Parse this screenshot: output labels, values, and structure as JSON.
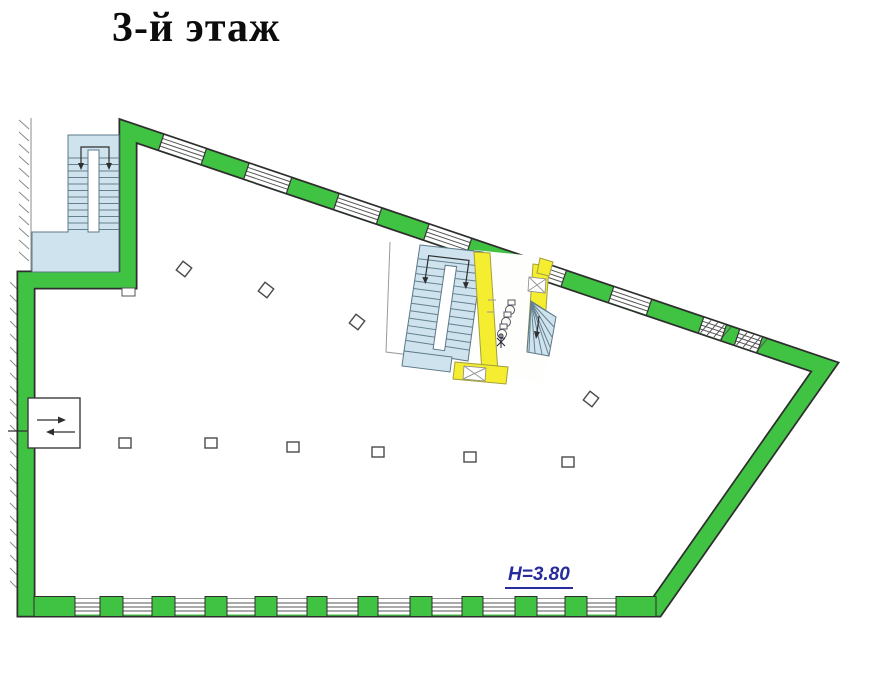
{
  "title": {
    "text": "3-й этаж"
  },
  "plan": {
    "height_label": "H=3.80",
    "colors": {
      "wall_green": "#40c342",
      "stair_blue": "#cfe3ee",
      "core_yellow": "#f5ed30",
      "label_blue": "#272c9c",
      "outline_dark": "#2e2e2e",
      "window_line": "#555555"
    },
    "top_wall_segments": [
      [
        "g",
        35
      ],
      [
        "w",
        45
      ],
      [
        "g",
        45
      ],
      [
        "w",
        45
      ],
      [
        "g",
        50
      ],
      [
        "w",
        45
      ],
      [
        "g",
        50
      ],
      [
        "w",
        45
      ],
      [
        "g",
        55
      ],
      [
        "w",
        45
      ],
      [
        "g",
        50
      ],
      [
        "w",
        40
      ],
      [
        "g",
        55
      ],
      [
        "h",
        24
      ],
      [
        "g",
        14
      ],
      [
        "h",
        24
      ],
      [
        "g",
        69
      ]
    ],
    "bottom_wall_piers": [
      [
        34,
        41
      ],
      [
        100,
        23
      ],
      [
        152,
        23
      ],
      [
        205,
        22
      ],
      [
        255,
        22
      ],
      [
        307,
        20
      ],
      [
        358,
        20
      ],
      [
        410,
        22
      ],
      [
        462,
        21
      ],
      [
        515,
        22
      ],
      [
        565,
        22
      ],
      [
        616,
        40
      ]
    ],
    "columns": {
      "tilted": [
        [
          184,
          269
        ],
        [
          266,
          290
        ],
        [
          357,
          322
        ],
        [
          591,
          399
        ]
      ],
      "upright": [
        [
          125,
          443
        ],
        [
          211,
          443
        ],
        [
          293,
          447
        ],
        [
          378,
          452
        ],
        [
          470,
          457
        ],
        [
          568,
          462
        ]
      ]
    }
  }
}
